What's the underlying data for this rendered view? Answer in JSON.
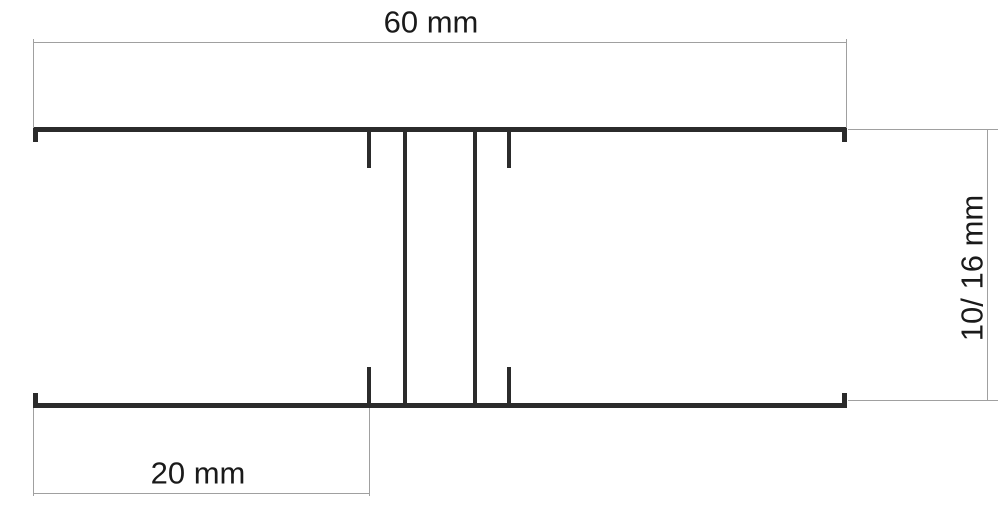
{
  "diagram": {
    "type": "technical-cross-section",
    "subject": "H-shaped joining profile cross-section with dimension lines",
    "colors": {
      "profile": "#2b2b2b",
      "dimension": "#a0a0a0",
      "text": "#1a1a1a",
      "background": "#ffffff"
    },
    "dimensions": {
      "overall_width": {
        "label": "60 mm"
      },
      "edge_offset": {
        "label": "20 mm"
      },
      "profile_height": {
        "label": "10/ 16 mm"
      }
    }
  }
}
